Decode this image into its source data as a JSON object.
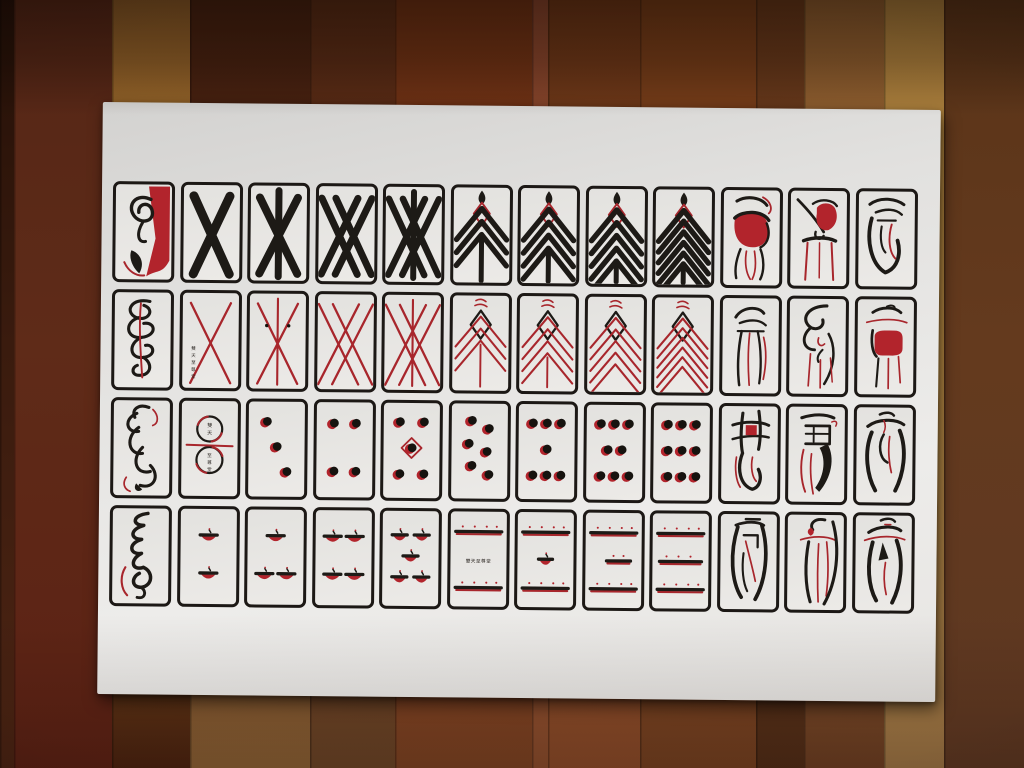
{
  "scene": {
    "type": "photograph",
    "description": "Printed sheet of 48 abstract black-and-red playing cards (four suits of 12) on a white board lying on a wooden plank floor",
    "maker_mark": "雙天至尊堂",
    "colors": {
      "ink_black": "#1d1a16",
      "ink_red_line": "#a8262c",
      "ink_red_fill": "#b2242c",
      "card_face": "#eceae7",
      "paper_light": "#edecea",
      "paper_shadow": "#d3d2d0"
    },
    "floor": {
      "planks": [
        {
          "x": 0,
          "w": 14,
          "c": [
            "#241007",
            "#3a1b0e",
            "#4c2413"
          ]
        },
        {
          "x": 14,
          "w": 98,
          "c": [
            "#542616",
            "#5f2b18",
            "#5c2114"
          ]
        },
        {
          "x": 112,
          "w": 78,
          "c": [
            "#8a5a26",
            "#a8782f",
            "#4a220f"
          ]
        },
        {
          "x": 190,
          "w": 120,
          "c": [
            "#44200f",
            "#502413",
            "#8a6034"
          ]
        },
        {
          "x": 310,
          "w": 85,
          "c": [
            "#562a14",
            "#5e2d18",
            "#6a4426"
          ]
        },
        {
          "x": 395,
          "w": 137,
          "c": [
            "#6c3012",
            "#76361c",
            "#7c4222"
          ]
        },
        {
          "x": 532,
          "w": 16,
          "c": [
            "#84422a",
            "#8a4a2c",
            "#8a4c2c"
          ]
        },
        {
          "x": 548,
          "w": 92,
          "c": [
            "#6a3415",
            "#744020",
            "#8a4a28"
          ]
        },
        {
          "x": 640,
          "w": 116,
          "c": [
            "#723a16",
            "#7c4220",
            "#744020"
          ]
        },
        {
          "x": 756,
          "w": 48,
          "c": [
            "#643618",
            "#6a3c20",
            "#502c16"
          ]
        },
        {
          "x": 804,
          "w": 80,
          "c": [
            "#8a5a2c",
            "#946434",
            "#6c3e22"
          ]
        },
        {
          "x": 884,
          "w": 60,
          "c": [
            "#a87c3a",
            "#b08440",
            "#9c7444"
          ]
        },
        {
          "x": 944,
          "w": 80,
          "c": [
            "#5a3418",
            "#643a1e",
            "#5e3822"
          ]
        }
      ]
    }
  },
  "sheet": {
    "rows": [
      {
        "suit": "black batons (bold black strokes)",
        "cards": [
          {
            "name": "1 of batons — red seal ace",
            "motif": "art",
            "art": "r1a"
          },
          {
            "name": "2 of batons",
            "motif": "bx",
            "rank": 2
          },
          {
            "name": "3 of batons",
            "motif": "bx",
            "rank": 3
          },
          {
            "name": "4 of batons",
            "motif": "bx",
            "rank": 4
          },
          {
            "name": "5 of batons",
            "motif": "bx",
            "rank": 5
          },
          {
            "name": "6 of batons",
            "motif": "bchev",
            "rank": 6
          },
          {
            "name": "7 of batons",
            "motif": "bchev",
            "rank": 7
          },
          {
            "name": "8 of batons",
            "motif": "bchev",
            "rank": 8
          },
          {
            "name": "9 of batons",
            "motif": "bchev",
            "rank": 9
          },
          {
            "name": "court of batons — red cap figure",
            "motif": "art",
            "art": "r1c10"
          },
          {
            "name": "court of batons — figure on stool",
            "motif": "art",
            "art": "r1c11"
          },
          {
            "name": "court of batons — black glyph",
            "motif": "art",
            "art": "r1c12"
          }
        ]
      },
      {
        "suit": "red strings (thin red strokes)",
        "cards": [
          {
            "name": "1 of strings — black coil",
            "motif": "art",
            "art": "r2a"
          },
          {
            "name": "2 of strings — with maker's mark",
            "motif": "rx",
            "rank": 2,
            "inscription": "雙天至尊堂"
          },
          {
            "name": "3 of strings",
            "motif": "rx",
            "rank": 3
          },
          {
            "name": "4 of strings",
            "motif": "rx",
            "rank": 4
          },
          {
            "name": "5 of strings",
            "motif": "rx",
            "rank": 5
          },
          {
            "name": "6 of strings",
            "motif": "rchev",
            "rank": 6
          },
          {
            "name": "7 of strings",
            "motif": "rchev",
            "rank": 7
          },
          {
            "name": "8 of strings",
            "motif": "rchev",
            "rank": 8
          },
          {
            "name": "9 of strings",
            "motif": "rchev",
            "rank": 9
          },
          {
            "name": "court of strings — robed figure",
            "motif": "art",
            "art": "r2c10"
          },
          {
            "name": "court of strings — coiled figure",
            "motif": "art",
            "art": "r2c11"
          },
          {
            "name": "court of strings — red tablet figure",
            "motif": "art",
            "art": "r2c12"
          }
        ]
      },
      {
        "suit": "coins (black dots with red glints)",
        "cards": [
          {
            "name": "1 of coins — black beast",
            "motif": "art",
            "art": "r3a"
          },
          {
            "name": "2 of coins — double rings with maker's mark",
            "motif": "rings",
            "inscription_top": "雙天",
            "inscription_bottom": "至尊堂"
          },
          {
            "name": "3 of coins",
            "motif": "coins",
            "rank": 3
          },
          {
            "name": "4 of coins",
            "motif": "coins",
            "rank": 4
          },
          {
            "name": "5 of coins — diamond centre",
            "motif": "coins",
            "rank": 5
          },
          {
            "name": "6 of coins",
            "motif": "coins",
            "rank": 6
          },
          {
            "name": "7 of coins",
            "motif": "coins",
            "rank": 7
          },
          {
            "name": "8 of coins",
            "motif": "coins",
            "rank": 8
          },
          {
            "name": "9 of coins",
            "motif": "coins",
            "rank": 9
          },
          {
            "name": "court of coins — lattice figure",
            "motif": "art",
            "art": "r3c10"
          },
          {
            "name": "court of coins — banner figure",
            "motif": "art",
            "art": "r3c11"
          },
          {
            "name": "court of coins — arch figure",
            "motif": "art",
            "art": "r3c12"
          }
        ]
      },
      {
        "suit": "cups (black caps over red bowls)",
        "cards": [
          {
            "name": "1 of cups — black scroll",
            "motif": "art",
            "art": "r4a"
          },
          {
            "name": "2 of cups",
            "motif": "cups",
            "rank": 2
          },
          {
            "name": "3 of cups",
            "motif": "cups",
            "rank": 3
          },
          {
            "name": "4 of cups",
            "motif": "cups",
            "rank": 4
          },
          {
            "name": "5 of cups",
            "motif": "cups",
            "rank": 5
          },
          {
            "name": "6 of cups — maker's mark",
            "motif": "bars",
            "rank": 6,
            "inscription": "雙天至尊堂"
          },
          {
            "name": "7 of cups",
            "motif": "bars",
            "rank": 7
          },
          {
            "name": "8 of cups",
            "motif": "bars",
            "rank": 8
          },
          {
            "name": "9 of cups",
            "motif": "bars",
            "rank": 9
          },
          {
            "name": "court of cups — gate figure",
            "motif": "art",
            "art": "r4c10"
          },
          {
            "name": "court of cups — staff figure",
            "motif": "art",
            "art": "r4c11"
          },
          {
            "name": "court of cups — arch figure",
            "motif": "art",
            "art": "r4c12"
          }
        ]
      }
    ]
  }
}
